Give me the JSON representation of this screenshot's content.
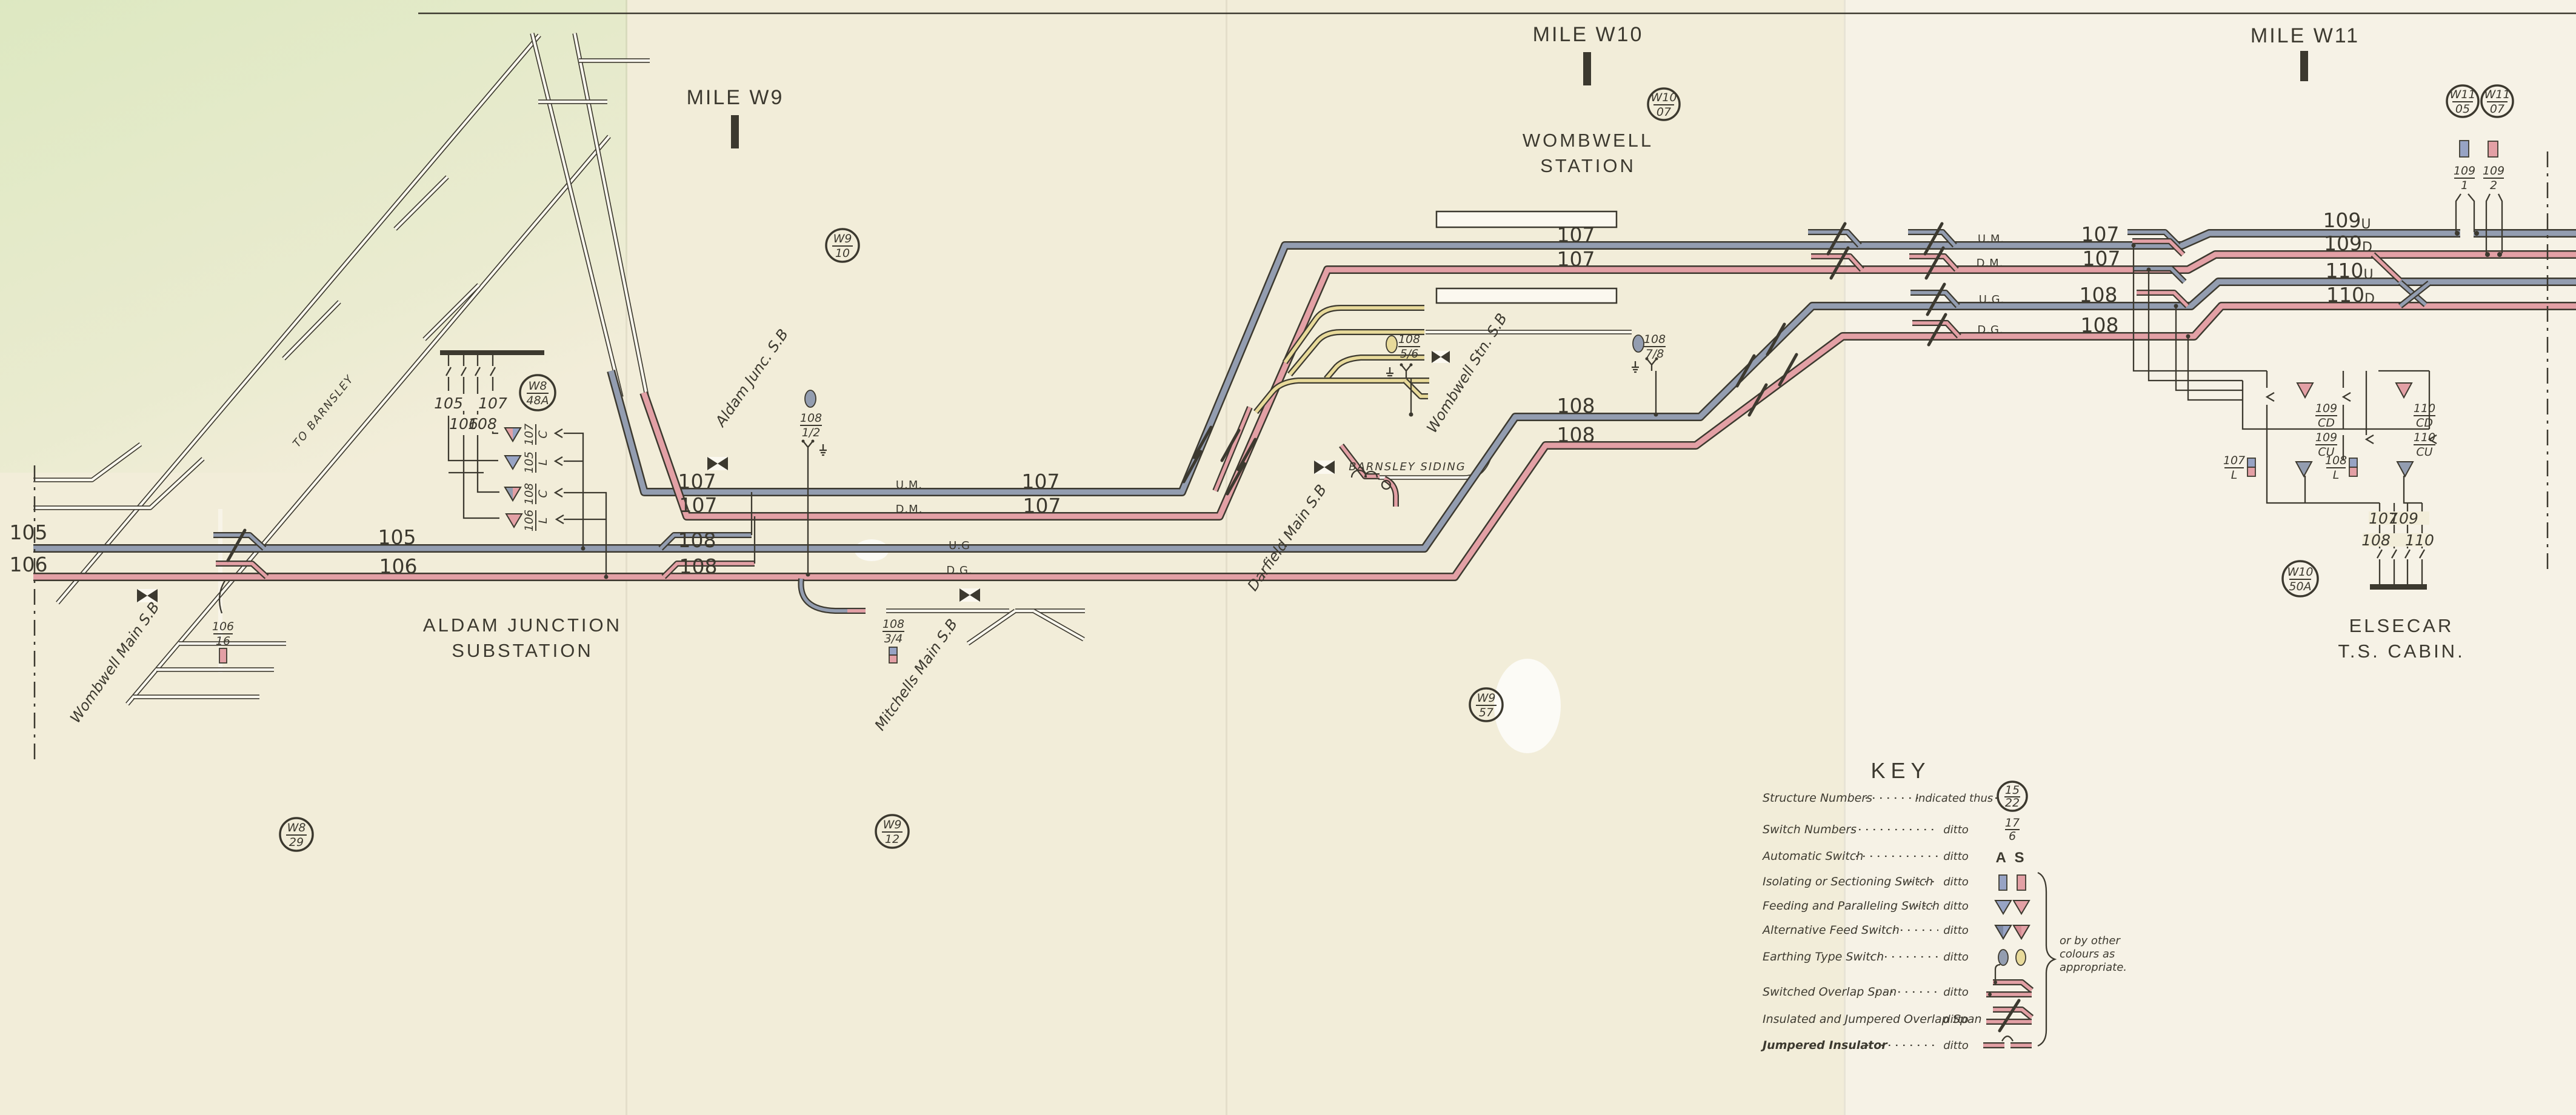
{
  "palette": {
    "paper": "#f2edd9",
    "paper2": "#f6f2e6",
    "green": "#dce8c0",
    "ink": "#3c392f",
    "grey": "#939db0",
    "blue": "#97a3c4",
    "pink": "#e3a0a5",
    "yellow": "#e8da9a",
    "chan": "#fbf8ef"
  },
  "mileposts": {
    "w9": "MILE W9",
    "w10": "MILE W10",
    "w11": "MILE W11"
  },
  "places": {
    "wombwell1": "WOMBWELL",
    "wombwell2": "STATION",
    "aldam1": "ALDAM JUNCTION",
    "aldam2": "SUBSTATION",
    "elsecar1": "ELSECAR",
    "elsecar2": "T.S. CABIN.",
    "to_barnsley": "TO BARNSLEY",
    "barnsley_siding": "BARNSLEY SIDING"
  },
  "signal_boxes": {
    "wombwell_main": "Wombwell Main S.B",
    "aldam": "Aldam Junc. S.B",
    "mitchells": "Mitchells Main S.B",
    "darfield": "Darfield Main S.B",
    "wombwell_stn": "Wombwell Stn. S.B"
  },
  "nums": {
    "n105": "105",
    "n106": "106",
    "n107": "107",
    "n108": "108",
    "n109": "109",
    "n110": "110"
  },
  "suffix": {
    "u": "U",
    "d": "D"
  },
  "track_names": {
    "um": "U.M.",
    "dm": "D.M.",
    "ug": "U.G",
    "dg": "D.G.",
    "ug2": "U.G.",
    "dg2": "D.G."
  },
  "structures": {
    "w8_48a": {
      "top": "W8",
      "bot": "48A"
    },
    "w9_10": {
      "top": "W9",
      "bot": "10"
    },
    "w10_07": {
      "top": "W10",
      "bot": "07"
    },
    "w11_05": {
      "top": "W11",
      "bot": "05"
    },
    "w11_07": {
      "top": "W11",
      "bot": "07"
    },
    "w8_29": {
      "top": "W8",
      "bot": "29"
    },
    "w9_12": {
      "top": "W9",
      "bot": "12"
    },
    "w9_57": {
      "top": "W9",
      "bot": "57"
    },
    "w10_50a": {
      "top": "W10",
      "bot": "50A"
    }
  },
  "switches": {
    "s106_16": {
      "top": "106",
      "bot": "16"
    },
    "s108_12": {
      "top": "108",
      "bot": "1/2"
    },
    "s108_34": {
      "top": "108",
      "bot": "3/4"
    },
    "s108_56": {
      "top": "108",
      "bot": "5/6"
    },
    "s108_78": {
      "top": "108",
      "bot": "7/8"
    },
    "s109_1": {
      "top": "109",
      "bot": "1"
    },
    "s109_2": {
      "top": "109",
      "bot": "2"
    },
    "s107_l": {
      "top": "107",
      "bot": "L"
    },
    "s108_l": {
      "top": "108",
      "bot": "L"
    },
    "s109_cd": {
      "top": "109",
      "bot": "CD"
    },
    "s109_cu": {
      "top": "109",
      "bot": "CU"
    },
    "s110_cd": {
      "top": "110",
      "bot": "CD"
    },
    "s110_cu": {
      "top": "110",
      "bot": "CU"
    },
    "s107_c": {
      "top": "107",
      "bot": "C"
    },
    "s105_l": {
      "top": "105",
      "bot": "L"
    },
    "s108_c": {
      "top": "108",
      "bot": "C"
    },
    "s106_l": {
      "top": "106",
      "bot": "L"
    }
  },
  "feeders": {
    "sub": {
      "f1": "105",
      "f2": "107",
      "f3": "106",
      "f4": "108"
    },
    "cabin": {
      "f1": "107",
      "f2": "109",
      "f3": "108",
      "f4": "110"
    }
  },
  "key": {
    "title": "KEY",
    "indicated": "Indicated thus",
    "ditto": "ditto",
    "automatic": "A S",
    "note1": "or by other",
    "note2": "colours as",
    "note3": "appropriate.",
    "sample_structure": {
      "top": "15",
      "bot": "22"
    },
    "sample_switch": {
      "top": "17",
      "bot": "6"
    },
    "rows": [
      {
        "label": "Structure Numbers"
      },
      {
        "label": "Switch Numbers"
      },
      {
        "label": "Automatic Switch"
      },
      {
        "label": "Isolating or Sectioning Switch"
      },
      {
        "label": "Feeding and Paralleling Switch"
      },
      {
        "label": "Alternative Feed Switch"
      },
      {
        "label": "Earthing Type Switch"
      },
      {
        "label": "Switched Overlap Span"
      },
      {
        "label": "Insulated and Jumpered Overlap Span"
      },
      {
        "label": "Jumpered Insulator"
      }
    ]
  }
}
